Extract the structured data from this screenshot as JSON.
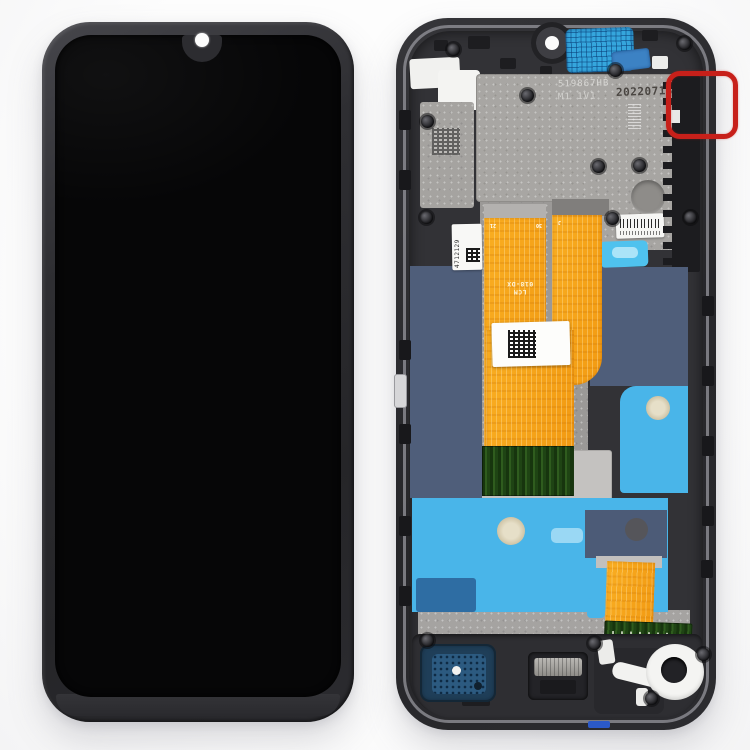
{
  "colors": {
    "background": "#fbfbfa",
    "annotation_red": "#c7201a",
    "flex_orange": "#f6a41e",
    "pcb_green": "#27491c",
    "adhesive_sky_blue": "#49b5e9",
    "adhesive_slate_blue": "#4f5e7a",
    "earpiece_mesh_blue": "#35a6dd",
    "frame_black": "#2c2c2f",
    "backplate_gray": "#a8a6a3",
    "screen_black": "#060607"
  },
  "back_frame": {
    "plate": {
      "serial": "519867HB",
      "model_code": "M1 1V1",
      "date_code": "20220713"
    },
    "side_label": {
      "number": "4712129"
    },
    "flex": {
      "label": "LCM",
      "part_number": "018-DX",
      "pins": [
        "21",
        "30",
        "J"
      ]
    }
  }
}
